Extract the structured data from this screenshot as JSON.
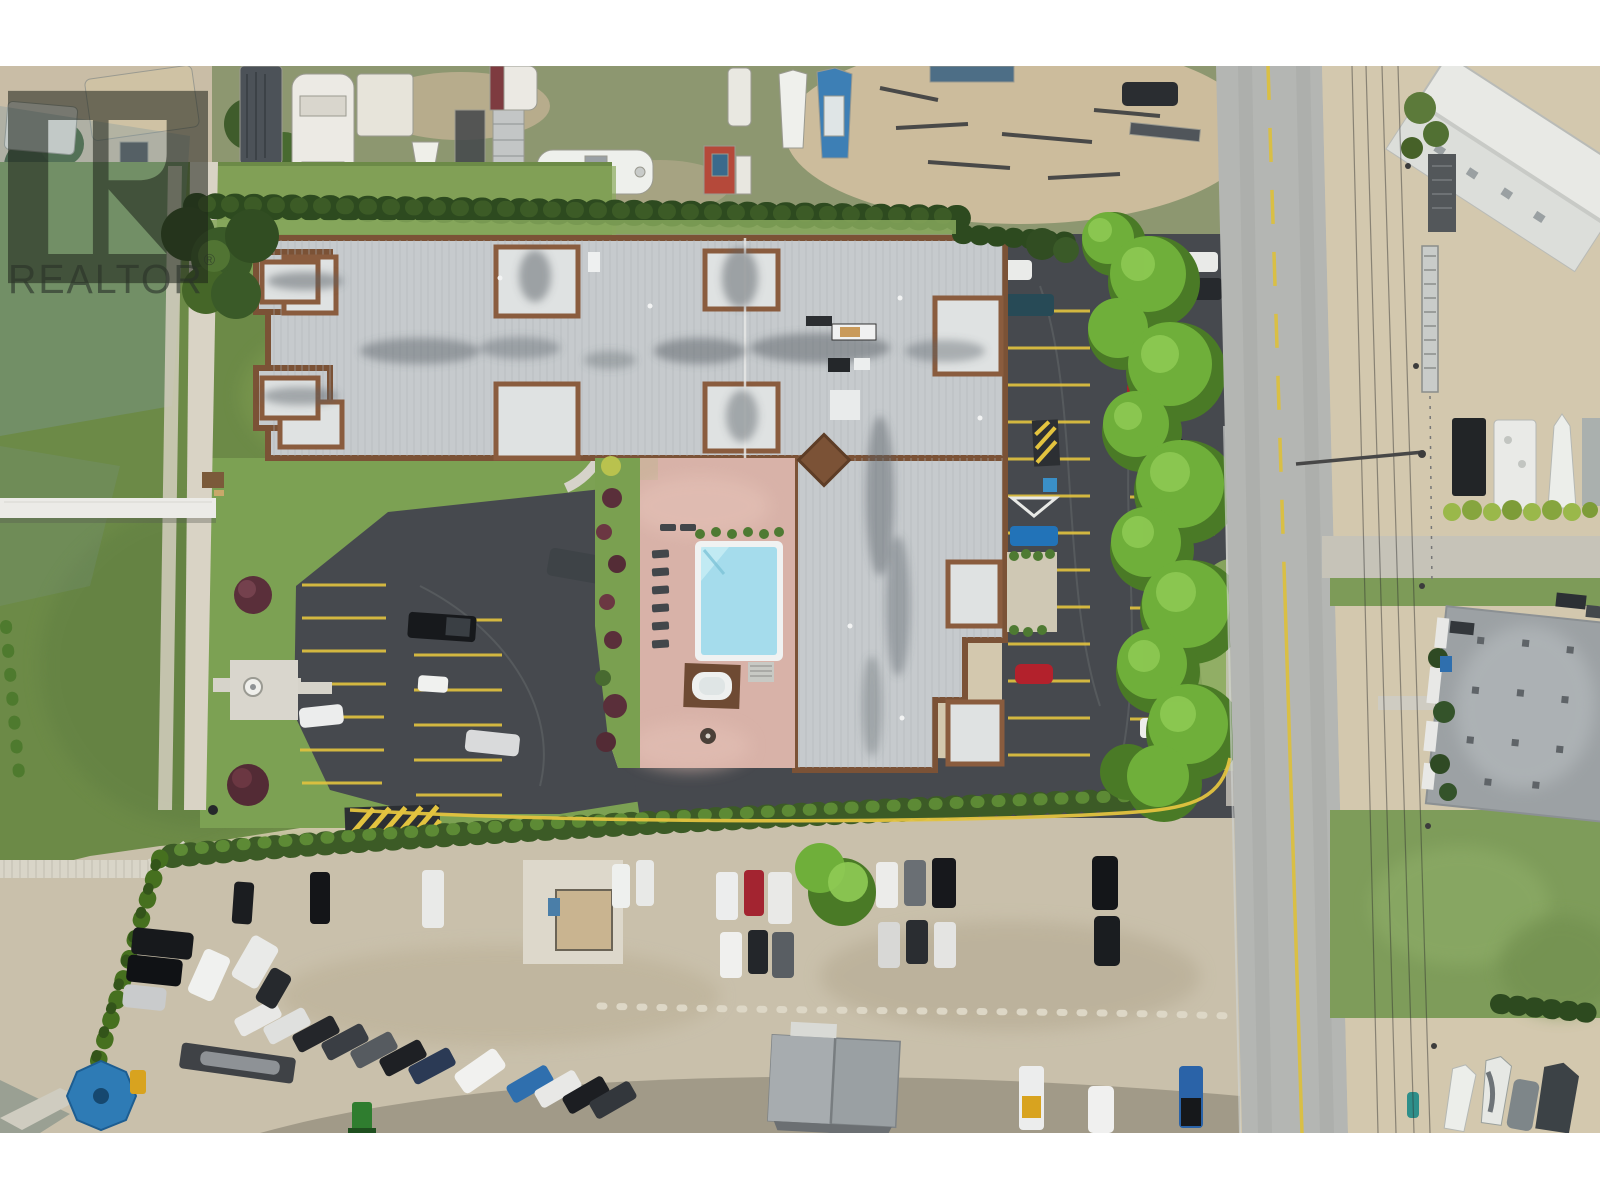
{
  "photo": {
    "alt": "Aerial drone photograph of a lakeside condominium complex with flat gray roof and brick trim, courtyard swimming pool with pink deck, asphalt parking lots with yellow stalls, a vertical street at right, RV and boat storage yards, gravel car lot at bottom, green marsh field at left and a white boardwalk dock"
  },
  "watermark": {
    "icon": "realtor-block-r-monogram",
    "text": "REALTOR",
    "reg": "®"
  },
  "palette": {
    "sand": "#d3c8ae",
    "gravel": "#c9c0ab",
    "yard-grass": "#8d9770",
    "field-green": "#6c8a47",
    "field-bright": "#8aa95c",
    "lawn": "#7ca153",
    "asphalt": "#46494e",
    "road": "#b4b6b3",
    "roof": "#c6cacd",
    "trim": "#7b5236",
    "deck": "#d8b2a8",
    "pool": "#a5dcec",
    "coping": "#f0f2f2",
    "hedge-dark": "#2d4a1f",
    "hedge-mid": "#3c5b26",
    "hedge-light": "#5d8a35",
    "tree": "#6faf3a",
    "tree-dark": "#4a7a26",
    "tree-light": "#8fcb55",
    "yellow": "#e3c33f",
    "white-paint": "#eceded",
    "concrete": "#d9d3c5",
    "marsh": "#7f98a0",
    "wm": "rgba(28,33,24,0.55)",
    "wm-text": "rgba(42,50,42,0.62)"
  }
}
